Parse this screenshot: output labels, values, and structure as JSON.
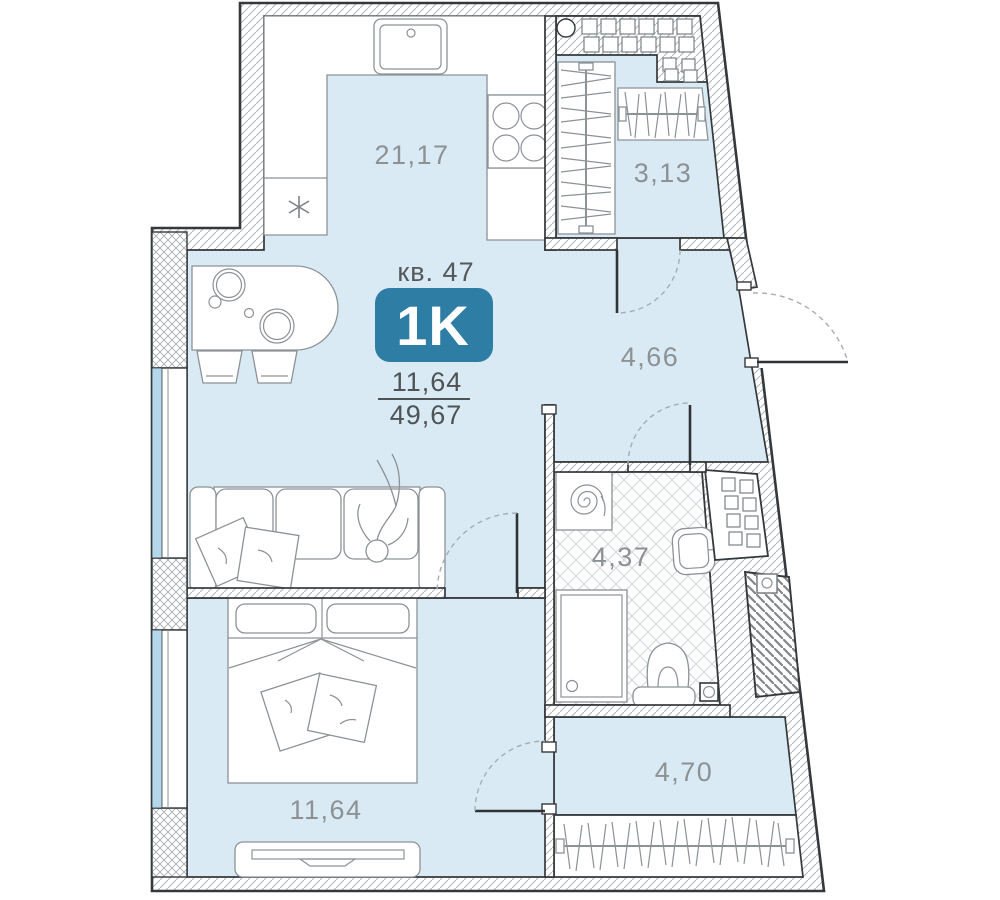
{
  "plan": {
    "header": {
      "apartment_label": "кв. 47",
      "type_badge": "1K",
      "area_living": "11,64",
      "area_total": "49,67"
    },
    "rooms": {
      "kitchen_living": {
        "area": "21,17"
      },
      "wardrobe_top": {
        "area": "3,13"
      },
      "hallway": {
        "area": "4,66"
      },
      "bathroom": {
        "area": "4,37"
      },
      "closet": {
        "area": "4,70"
      },
      "bedroom": {
        "area": "11,64"
      }
    },
    "colors": {
      "floor": "#d9eaf5",
      "window_glass": "#b5d7ec",
      "badge": "#2e7da4",
      "wall_line": "#35393b",
      "furniture_line": "#8d9296",
      "room_label": "#8c9194",
      "header_text": "#54595c"
    }
  }
}
